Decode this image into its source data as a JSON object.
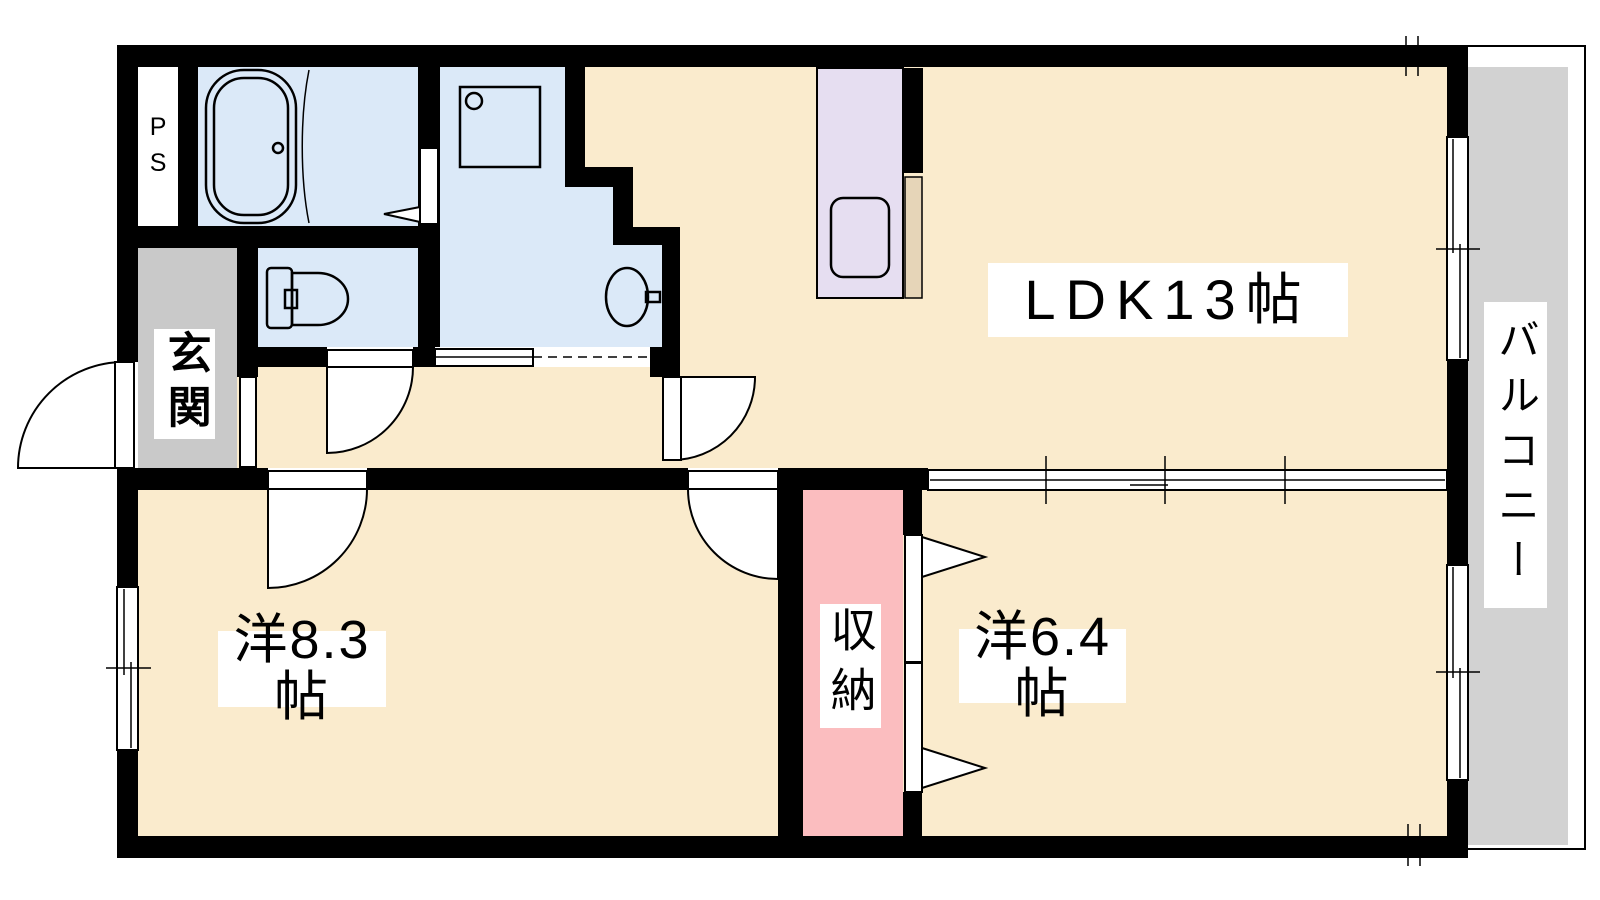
{
  "plan": {
    "labels": {
      "ldk": "LDK13帖",
      "western_room_large": "洋8.3帖",
      "western_room_small": "洋6.4帖",
      "storage": "収納",
      "entrance": "玄関",
      "balcony": "バルコニー",
      "pipe_space": "PS"
    },
    "colors": {
      "wall": "#000000",
      "room_floor": "#FAEBCD",
      "wet_area_floor": "#DBE9F8",
      "entrance_floor": "#C9C9C9",
      "balcony_floor": "#D2D2D2",
      "storage_floor": "#FBBDBF",
      "kitchen_counter": "#E6DEF1",
      "counter_edge": "#E6D5B8"
    }
  }
}
